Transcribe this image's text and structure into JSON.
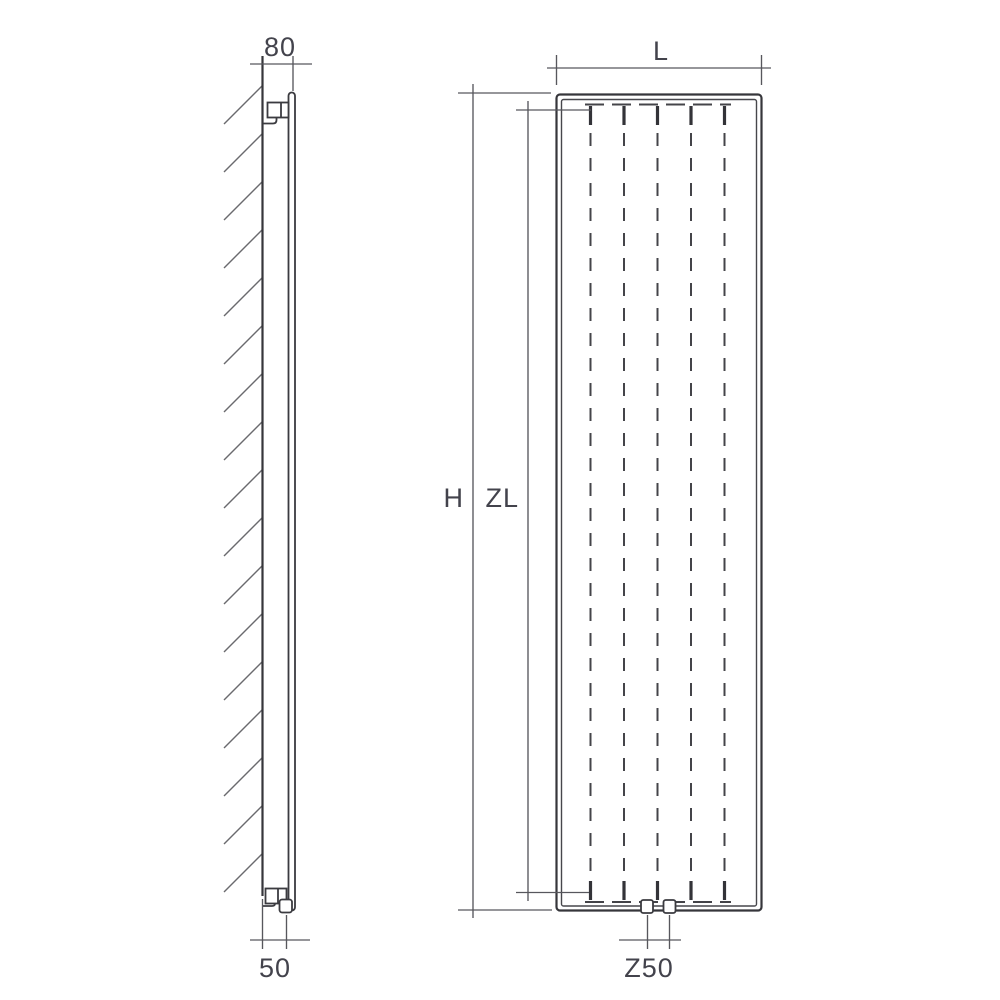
{
  "labels": {
    "side_depth": "80",
    "side_bottom_offset": "50",
    "front_width": "L",
    "front_height": "H",
    "front_inner_height": "ZL",
    "front_connection": "Z50"
  },
  "colors": {
    "background": "#ffffff",
    "part_line": "#3b3b40",
    "dimension_line": "#57575d",
    "hatch_line": "#6a6a6e",
    "label_text": "#43434c"
  }
}
